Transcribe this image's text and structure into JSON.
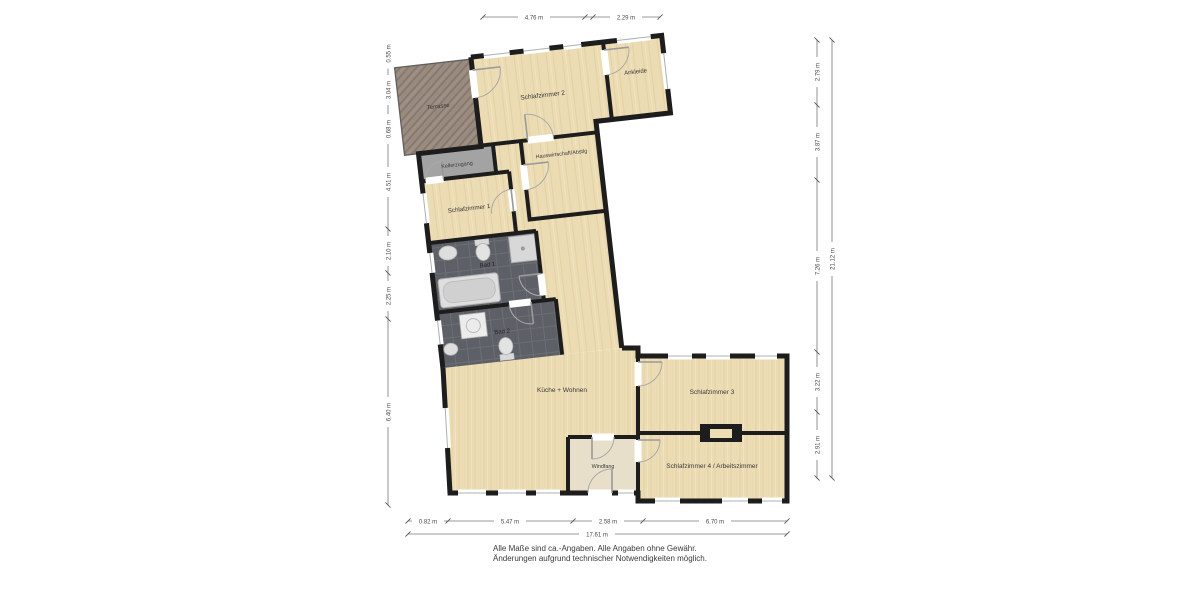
{
  "plan": {
    "rooms": {
      "terrasse": "Terrasse",
      "schlafzimmer2": "Schlafzimmer 2",
      "ankleide": "Ankleide",
      "kellerzugang": "Kellerzugang",
      "hauswirtschaft": "Hauswirtschaft/Abstlg",
      "schlafzimmer1": "Schlafzimmer 1",
      "bad1": "Bad 1",
      "bad2": "Bad 2",
      "kueche": "Küche + Wohnen",
      "windfang": "Windfang",
      "schlafzimmer3": "Schlafzimmer 3",
      "schlafzimmer4": "Schlafzimmer 4 / Arbeitszimmer"
    },
    "dimensions": {
      "top": [
        "4.76 m",
        "2.29 m"
      ],
      "bottom": [
        "0.82 m",
        "5.47 m",
        "2.58 m",
        "6.70 m"
      ],
      "bottom_total": "17.61 m",
      "left": [
        "0.55 m",
        "3.04 m",
        "0.68 m",
        "4.51 m",
        "2.10 m",
        "2.25 m",
        "6.40 m"
      ],
      "right": [
        "2.79 m",
        "3.87 m",
        "7.26 m",
        "3.22 m",
        "2.91 m"
      ],
      "right_total": "21.12 m"
    },
    "disclaimer": {
      "line1": "Alle Maße sind ca.-Angaben. Alle Angaben ohne Gewähr.",
      "line2": "Änderungen aufgrund technischer Notwendigkeiten möglich."
    },
    "colors": {
      "wall": "#1d1d1d",
      "floor_wood": "#ecdcb4",
      "terrace_deck": "#998b7e",
      "wet_room_tile": "#5d6066",
      "service_room": "#a3a3a3",
      "dimension_line": "#777777"
    }
  }
}
